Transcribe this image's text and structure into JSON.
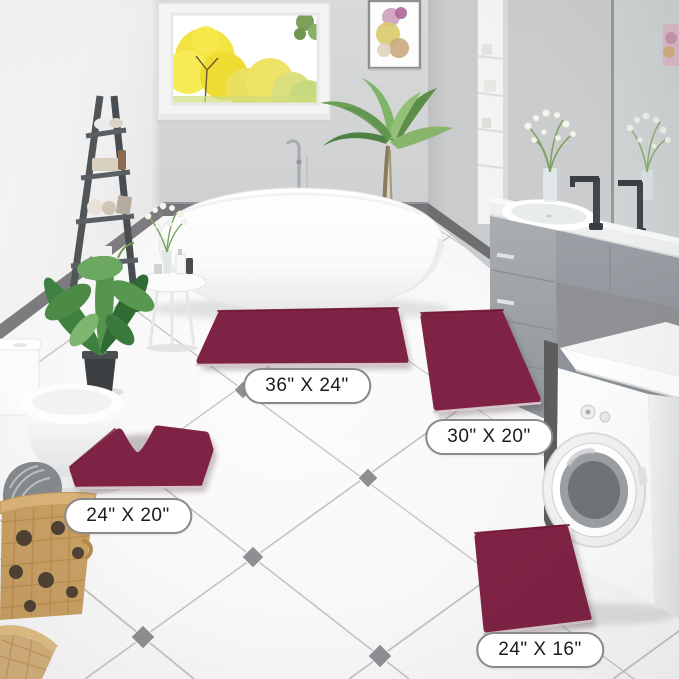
{
  "product_labels": {
    "rug_large": "36\" X 24\"",
    "rug_runner": "30\" X 20\"",
    "rug_contour": "24\" X 20\"",
    "rug_small": "24\" X 16\""
  },
  "colors": {
    "rug": "#8B1E3A",
    "rug_edge": "#6E172E",
    "rug_backing": "#D9CBCF",
    "label_border": "#8A8A8A",
    "label_text": "#1C1C1C",
    "grout": "#C3C3C5",
    "tile_accent": "#8E8F92",
    "baseboard": "#76767A",
    "cabinet": "#9BA1A6",
    "ladder": "#50555A"
  }
}
